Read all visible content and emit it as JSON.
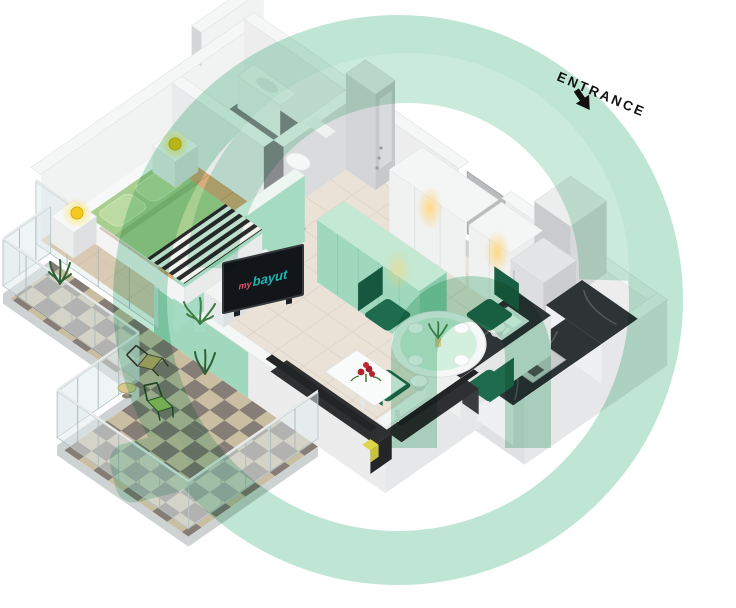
{
  "entrance": {
    "label": "ENTRANCE",
    "arrow_direction": "down-left"
  },
  "tv_screen": {
    "prefix": "my",
    "brand": "bayut",
    "prefix_color": "#e8566e",
    "brand_color": "#1ab8b4",
    "screen_color": "#121519"
  },
  "watermark": {
    "brand": "bayut",
    "color": "#7fcda9",
    "opacity": 0.5,
    "shape": "ring-with-arch-door-window"
  },
  "palette": {
    "background": "#ffffff",
    "wall_top": "#f5f6f6",
    "wall_inner": "#f1f2f2",
    "wall_outer": "#e6e7e8",
    "mint_wall": "#9fd8bd",
    "mint_cabinet_top": "#c3e8d4",
    "tile_floor": "#eae1d7",
    "wood_floor": "#d7ab7a",
    "bath_floor": "#888b8d",
    "balcony_tile_light": "#c9bda2",
    "balcony_tile_dark": "#857d76",
    "marble_counter": "#2e3335",
    "sofa": "#2e2f30",
    "dining_chair": "#1f6b4e",
    "bed_duvet": "#a9cf90",
    "pillow": "#bcdba3",
    "stripe": "#2c2c2c",
    "lamp_yellow": "#f5c91d",
    "flower_red": "#b4222e",
    "plant_green": "#3f7d46",
    "glass": "#dfeaeb",
    "fridge": "#dcdee0"
  },
  "rooms": {
    "bedroom": {
      "floor": "wood",
      "furniture": [
        "double-bed",
        "pillows",
        "striped-runner",
        "nightstand-left",
        "nightstand-right",
        "table-lamp-left",
        "table-lamp-right",
        "headboard"
      ]
    },
    "bathroom": {
      "floor": "dark-tile",
      "furniture": [
        "vanity",
        "toilet"
      ]
    },
    "hallway": {
      "floor": "tile",
      "furniture": [
        "wardrobe-left",
        "wardrobe-right",
        "ceiling-spotlights"
      ]
    },
    "kitchen": {
      "floor": "tile",
      "furniture": [
        "island-with-sink",
        "bar-stools",
        "back-counter",
        "side-counter-with-stove",
        "fridge",
        "mint-cabinets"
      ]
    },
    "living_dining": {
      "floor": "tile",
      "furniture": [
        "corner-sofa",
        "coffee-table",
        "red-flowers",
        "tv-stand",
        "tv",
        "dining-table",
        "dining-chairs",
        "floor-lamp",
        "plant"
      ]
    },
    "balcony": {
      "floor": "checker-tile",
      "railing": "glass",
      "furniture": [
        "patio-chair-tan",
        "patio-chair-green",
        "side-table",
        "plants"
      ]
    }
  },
  "counts": {
    "dining_chairs": 4,
    "bar_stools": 4,
    "patio_chairs": 2,
    "table_lamps": 2
  }
}
